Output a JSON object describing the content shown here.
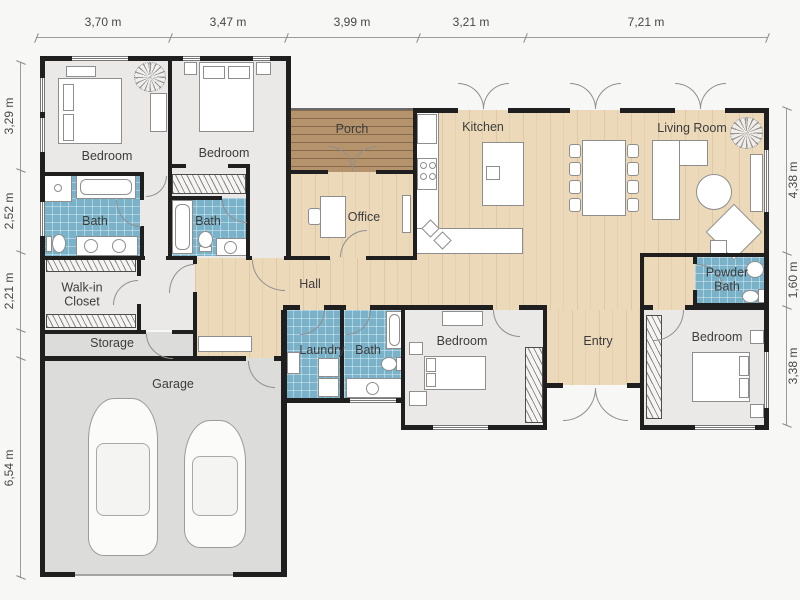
{
  "dimensions": {
    "top": [
      "3,70 m",
      "3,47 m",
      "3,99 m",
      "3,21 m",
      "7,21 m"
    ],
    "left": [
      "3,29 m",
      "2,52 m",
      "2,21 m",
      "6,54 m"
    ],
    "right": [
      "4,38 m",
      "1,60 m",
      "3,38 m"
    ]
  },
  "rooms": {
    "bedroom1": "Bedroom",
    "bedroom2": "Bedroom",
    "bath1": "Bath",
    "bath2": "Bath",
    "walkin": "Walk-in Closet",
    "storage": "Storage",
    "garage": "Garage",
    "porch": "Porch",
    "office": "Office",
    "hall": "Hall",
    "kitchen": "Kitchen",
    "living": "Living Room",
    "powder": "Powder Bath",
    "laundry": "Laundry",
    "bath3": "Bath",
    "bedroom3": "Bedroom",
    "entry": "Entry",
    "bedroom4": "Bedroom"
  },
  "colors": {
    "wall": "#1f1f1f",
    "bath_tile": "#79b2c9",
    "wood_floor": "#ebd9ba",
    "porch_deck": "#b5936c",
    "room_floor": "#eae9e7",
    "garage_floor": "#dcdcda"
  }
}
